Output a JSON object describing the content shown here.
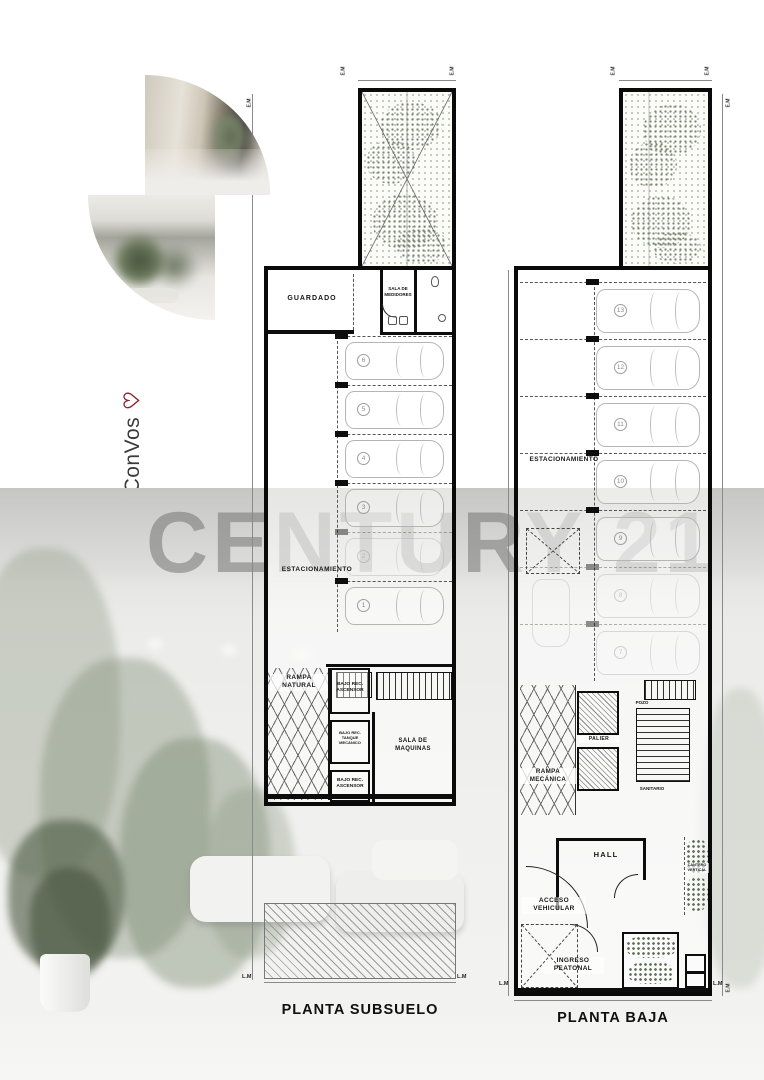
{
  "branding": {
    "watermark": "CENTURY 21",
    "tagline": {
      "hash_part": "#Inversión",
      "rest_part": "ConVos",
      "heart": "♡"
    },
    "colors": {
      "accent_red": "#8f1f2c",
      "dark_text": "#333333",
      "watermark_gray": "#6c6c6c"
    }
  },
  "annotations": {
    "em": "E.M",
    "lm": "L.M"
  },
  "plan_subsuelo": {
    "title": "PLANTA SUBSUELO",
    "labels": {
      "guardado": "GUARDADO",
      "sala_medidores_1": "SALA DE",
      "sala_medidores_2": "MEDIDORES",
      "estacionamiento": "ESTACIONAMIENTO",
      "rampa_1": "RAMPA",
      "rampa_2": "NATURAL",
      "bajo_rec_1a": "BAJO REC.",
      "bajo_rec_1b": "ASCENSOR",
      "tanque_1": "BAJO REC.",
      "tanque_2": "TANQUE",
      "tanque_3": "MECÁNICO",
      "bajo_rec_2a": "BAJO REC.",
      "bajo_rec_2b": "ASCENSOR",
      "sala_maquinas_1": "SALA DE",
      "sala_maquinas_2": "MAQUINAS"
    },
    "parking": [
      "6",
      "5",
      "4",
      "3",
      "2",
      "1"
    ]
  },
  "plan_baja": {
    "title": "PLANTA BAJA",
    "labels": {
      "estacionamiento": "ESTACIONAMIENTO",
      "rampa_1": "RAMPA",
      "rampa_2": "MECÁNICA",
      "palier": "PALIER",
      "pozo": "POZO",
      "sanitario": "SANITARIO",
      "hall": "HALL",
      "cantero_1": "CANTERO",
      "cantero_2": "VERTICAL",
      "acceso_1": "ACCESO",
      "acceso_2": "VEHICULAR",
      "ingreso_1": "INGRESO",
      "ingreso_2": "PEATONAL"
    },
    "parking": [
      "13",
      "12",
      "11",
      "10",
      "9",
      "8",
      "7"
    ]
  }
}
